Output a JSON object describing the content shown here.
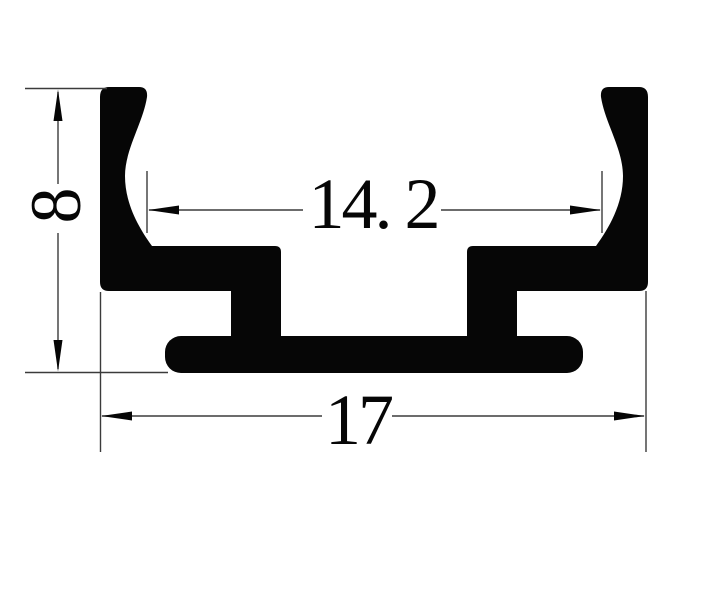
{
  "figure": {
    "type": "technical-drawing-cross-section",
    "background_color": "#ffffff",
    "ink_color": "#060606",
    "line_color": "#3b3b3b",
    "dimensions": {
      "height": {
        "label": "8",
        "value": 8,
        "orientation": "vertical",
        "side": "left"
      },
      "inner_width": {
        "label": "14. 2",
        "value": 14.2,
        "orientation": "horizontal",
        "position": "inside-channel"
      },
      "outer_width": {
        "label": "17",
        "value": 17,
        "orientation": "horizontal",
        "position": "below-profile"
      }
    }
  }
}
